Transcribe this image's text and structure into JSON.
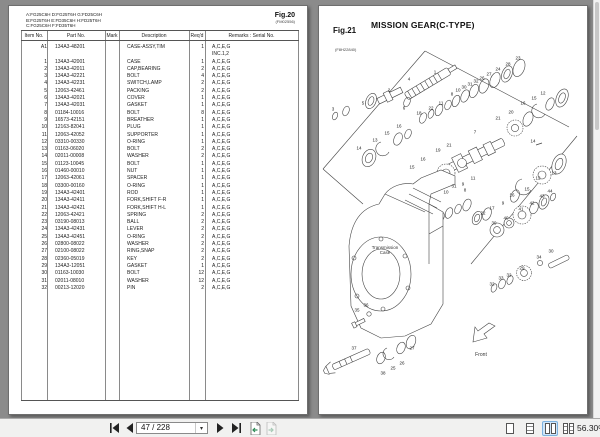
{
  "left_page": {
    "fig_label": "Fig.20",
    "fig_code": "(FM02556)",
    "model_lines": "A:FG25C6H D:FG25T6H G:FD25C6H\nB:FG25T6H E:FD35C6H H:FD25T6H\nC:FG25C6H F:FD35T6H",
    "table": {
      "headers": [
        "Item No.",
        "Part No.",
        "Mark",
        "Description",
        "Req'd",
        "Remarks : Serial No."
      ],
      "rows": [
        [
          "A1",
          "134A3-48201",
          "",
          "CASE-ASSY,TIM",
          "1",
          "A,C,E,G"
        ],
        [
          "",
          "",
          "",
          "",
          "",
          "INC.1,2"
        ],
        [
          "1",
          "134A3-42001",
          "",
          "CASE",
          "1",
          "A,C,E,G"
        ],
        [
          "2",
          "134A3-42011",
          "",
          "CAP,BEARING",
          "2",
          "A,C,E,G"
        ],
        [
          "3",
          "134A3-42221",
          "",
          "BOLT",
          "4",
          "A,C,E,G"
        ],
        [
          "4",
          "134A3-42231",
          "",
          "SWITCH,LAMP",
          "2",
          "A,C,E,G"
        ],
        [
          "5",
          "12063-42461",
          "",
          "PACKING",
          "2",
          "A,C,E,G"
        ],
        [
          "6",
          "134A3-42021",
          "",
          "COVER",
          "1",
          "A,C,E,G"
        ],
        [
          "7",
          "134A3-42031",
          "",
          "GASKET",
          "1",
          "A,C,E,G"
        ],
        [
          "8",
          "01184-10016",
          "",
          "BOLT",
          "8",
          "A,C,E,G"
        ],
        [
          "9",
          "16573-42151",
          "",
          "BREATHER",
          "1",
          "A,C,E,G"
        ],
        [
          "10",
          "12163-82041",
          "",
          "PLUG",
          "1",
          "A,C,E,G"
        ],
        [
          "11",
          "12063-42052",
          "",
          "SUPPORTER",
          "1",
          "A,C,E,G"
        ],
        [
          "12",
          "03310-00330",
          "",
          "O-RING",
          "1",
          "A,C,E,G"
        ],
        [
          "13",
          "01163-06020",
          "",
          "BOLT",
          "2",
          "A,C,E,G"
        ],
        [
          "14",
          "02011-00008",
          "",
          "WASHER",
          "2",
          "A,C,E,G"
        ],
        [
          "15",
          "01123-10045",
          "",
          "BOLT",
          "1",
          "A,C,E,G"
        ],
        [
          "16",
          "01460-00010",
          "",
          "NUT",
          "1",
          "A,C,E,G"
        ],
        [
          "17",
          "12063-42061",
          "",
          "SPACER",
          "1",
          "A,C,E,G"
        ],
        [
          "18",
          "03300-00160",
          "",
          "O-RING",
          "1",
          "A,C,E,G"
        ],
        [
          "19",
          "134A3-42401",
          "",
          "ROD",
          "1",
          "A,C,E,G"
        ],
        [
          "20",
          "134A3-42411",
          "",
          "FORK,SHIFT F-R",
          "1",
          "A,C,E,G"
        ],
        [
          "21",
          "134A3-42421",
          "",
          "FORK,SHIFT H-L",
          "1",
          "A,C,E,G"
        ],
        [
          "22",
          "12063-42421",
          "",
          "SPRING",
          "2",
          "A,C,E,G"
        ],
        [
          "23",
          "03190-08013",
          "",
          "BALL",
          "2",
          "A,C,E,G"
        ],
        [
          "24",
          "134A3-42431",
          "",
          "LEVER",
          "2",
          "A,C,E,G"
        ],
        [
          "25",
          "134A3-42451",
          "",
          "O-RING",
          "2",
          "A,C,E,G"
        ],
        [
          "26",
          "02800-08022",
          "",
          "WASHER",
          "2",
          "A,C,E,G"
        ],
        [
          "27",
          "02100-08022",
          "",
          "RING,SNAP",
          "2",
          "A,C,E,G"
        ],
        [
          "28",
          "02360-05019",
          "",
          "KEY",
          "2",
          "A,C,E,G"
        ],
        [
          "29",
          "134A3-12051",
          "",
          "GASKET",
          "1",
          "A,C,E,G"
        ],
        [
          "30",
          "01163-10030",
          "",
          "BOLT",
          "12",
          "A,C,E,G"
        ],
        [
          "31",
          "02011-08010",
          "",
          "WASHER",
          "12",
          "A,C,E,G"
        ],
        [
          "32",
          "00213-12020",
          "",
          "PIN",
          "2",
          "A,C,E,G"
        ]
      ]
    }
  },
  "right_page": {
    "fig_label": "Fig.21",
    "fig_code": "(F8H22840)",
    "title": "MISSION GEAR(C-TYPE)",
    "labels": {
      "transmission_case": "Transmission\nCase",
      "front": "Front"
    },
    "callouts": [
      {
        "n": "1",
        "x": 116,
        "y": 66
      },
      {
        "n": "2",
        "x": 70,
        "y": 84
      },
      {
        "n": "3",
        "x": 14,
        "y": 103
      },
      {
        "n": "4",
        "x": 90,
        "y": 73
      },
      {
        "n": "5",
        "x": 44,
        "y": 97
      },
      {
        "n": "6",
        "x": 85,
        "y": 102
      },
      {
        "n": "18",
        "x": 100,
        "y": 107
      },
      {
        "n": "22",
        "x": 112,
        "y": 102
      },
      {
        "n": "11",
        "x": 122,
        "y": 97
      },
      {
        "n": "8",
        "x": 133,
        "y": 88
      },
      {
        "n": "10",
        "x": 139,
        "y": 84
      },
      {
        "n": "30",
        "x": 145,
        "y": 81
      },
      {
        "n": "31",
        "x": 151,
        "y": 78
      },
      {
        "n": "32",
        "x": 157,
        "y": 75
      },
      {
        "n": "26",
        "x": 163,
        "y": 72
      },
      {
        "n": "27",
        "x": 170,
        "y": 68
      },
      {
        "n": "24",
        "x": 179,
        "y": 63
      },
      {
        "n": "28",
        "x": 189,
        "y": 58
      },
      {
        "n": "23",
        "x": 199,
        "y": 52
      },
      {
        "n": "16",
        "x": 80,
        "y": 120
      },
      {
        "n": "15",
        "x": 68,
        "y": 127
      },
      {
        "n": "13",
        "x": 56,
        "y": 134
      },
      {
        "n": "14",
        "x": 40,
        "y": 142
      },
      {
        "n": "7",
        "x": 156,
        "y": 126
      },
      {
        "n": "21",
        "x": 179,
        "y": 112
      },
      {
        "n": "20",
        "x": 192,
        "y": 106
      },
      {
        "n": "16",
        "x": 204,
        "y": 97
      },
      {
        "n": "15",
        "x": 215,
        "y": 92
      },
      {
        "n": "12",
        "x": 224,
        "y": 87
      },
      {
        "n": "19",
        "x": 119,
        "y": 144
      },
      {
        "n": "21",
        "x": 130,
        "y": 139
      },
      {
        "n": "16",
        "x": 104,
        "y": 153
      },
      {
        "n": "15",
        "x": 93,
        "y": 161
      },
      {
        "n": "14",
        "x": 214,
        "y": 135
      },
      {
        "n": "12",
        "x": 219,
        "y": 172
      },
      {
        "n": "13",
        "x": 235,
        "y": 167
      },
      {
        "n": "15",
        "x": 208,
        "y": 183
      },
      {
        "n": "16",
        "x": 193,
        "y": 189
      },
      {
        "n": "10",
        "x": 127,
        "y": 186
      },
      {
        "n": "31",
        "x": 135,
        "y": 180
      },
      {
        "n": "9",
        "x": 144,
        "y": 178
      },
      {
        "n": "11",
        "x": 154,
        "y": 172
      },
      {
        "n": "8",
        "x": 146,
        "y": 184
      },
      {
        "n": "22",
        "x": 164,
        "y": 207
      },
      {
        "n": "17",
        "x": 173,
        "y": 202
      },
      {
        "n": "9",
        "x": 184,
        "y": 197
      },
      {
        "n": "39",
        "x": 175,
        "y": 217
      },
      {
        "n": "40",
        "x": 187,
        "y": 212
      },
      {
        "n": "41",
        "x": 202,
        "y": 203
      },
      {
        "n": "42",
        "x": 213,
        "y": 197
      },
      {
        "n": "43",
        "x": 223,
        "y": 190
      },
      {
        "n": "44",
        "x": 231,
        "y": 185
      },
      {
        "n": "30",
        "x": 232,
        "y": 245
      },
      {
        "n": "34",
        "x": 220,
        "y": 251
      },
      {
        "n": "29",
        "x": 203,
        "y": 262
      },
      {
        "n": "32",
        "x": 190,
        "y": 269
      },
      {
        "n": "33",
        "x": 182,
        "y": 272
      },
      {
        "n": "32",
        "x": 173,
        "y": 278
      },
      {
        "n": "35",
        "x": 38,
        "y": 304
      },
      {
        "n": "36",
        "x": 47,
        "y": 299
      },
      {
        "n": "37",
        "x": 35,
        "y": 342
      },
      {
        "n": "38",
        "x": 64,
        "y": 367
      },
      {
        "n": "25",
        "x": 74,
        "y": 362
      },
      {
        "n": "26",
        "x": 83,
        "y": 357
      },
      {
        "n": "27",
        "x": 93,
        "y": 342
      }
    ]
  },
  "toolbar": {
    "page_input": "47 / 228",
    "zoom_level": "56.30%",
    "icons": [
      "first-page-icon",
      "previous-page-icon",
      "page-dropdown-caret-icon",
      "next-page-icon",
      "last-page-icon",
      "previous-view-icon",
      "next-view-icon",
      "single-page-icon",
      "continuous-icon",
      "two-up-icon",
      "two-up-continuous-icon"
    ]
  },
  "colors": {
    "canvas": "#8b8b8b",
    "page": "#ffffff",
    "selection": "#cfe6fa",
    "line": "#444444"
  }
}
